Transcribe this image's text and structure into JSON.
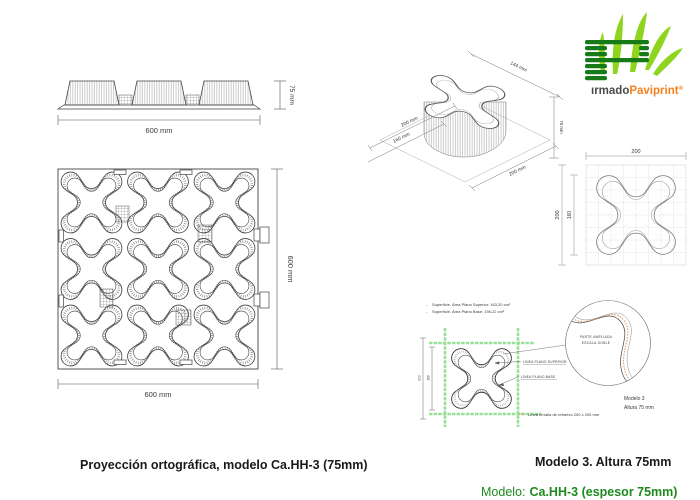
{
  "doc": {
    "caption_left": "Proyección ortográfica, modelo Ca.HH-3 (75mm)",
    "caption_right": "Modelo 3. Altura 75mm",
    "model_label": "Modelo:",
    "model_value": "Ca.HH-3 (espesor 75mm)"
  },
  "logo": {
    "prefix": "ırmado",
    "brand": "Paviprint",
    "reg": "®",
    "dark_green": "#157a17",
    "light_green": "#8fd41f",
    "orange": "#f58220",
    "prefix_color": "#4a4a4a"
  },
  "elevation": {
    "dim_height": "75 mm",
    "dim_width": "600 mm"
  },
  "plan": {
    "dim_right": "600 mm",
    "dim_bottom": "600 mm"
  },
  "isometric": {
    "dim_top": "144 mm",
    "dim_height": "75 mm",
    "dim_bottom_right": "200 mm",
    "dim_left_inner": "200 mm",
    "dim_left_outer": "160 mm"
  },
  "cell": {
    "dim_top": "200",
    "dim_left_outer": "200",
    "dim_left_inner": "160"
  },
  "detail": {
    "bullet": "-",
    "surface_line1": "Superficie. Área Plano Superior: 163,20 cm²",
    "surface_line2": "Superficie. Área Plano Base: 196,22 cm²",
    "label_superior": "LÍNEA PLANO SUPERIOR",
    "label_base": "LÍNEA PLANO BASE",
    "zoom_line1": "PARTE AMPLIADA",
    "zoom_line2": "ESCALA DOBLE",
    "rebar_note": "Línea ferralla de refuerzo 200 x 200 mm",
    "model_line1": "Modelo 3",
    "model_line2": "Altura 75 mm",
    "dim_outer": "200",
    "dim_inner": "160",
    "mesh_green": "#98e098",
    "accent_orange": "#dc9a62"
  }
}
